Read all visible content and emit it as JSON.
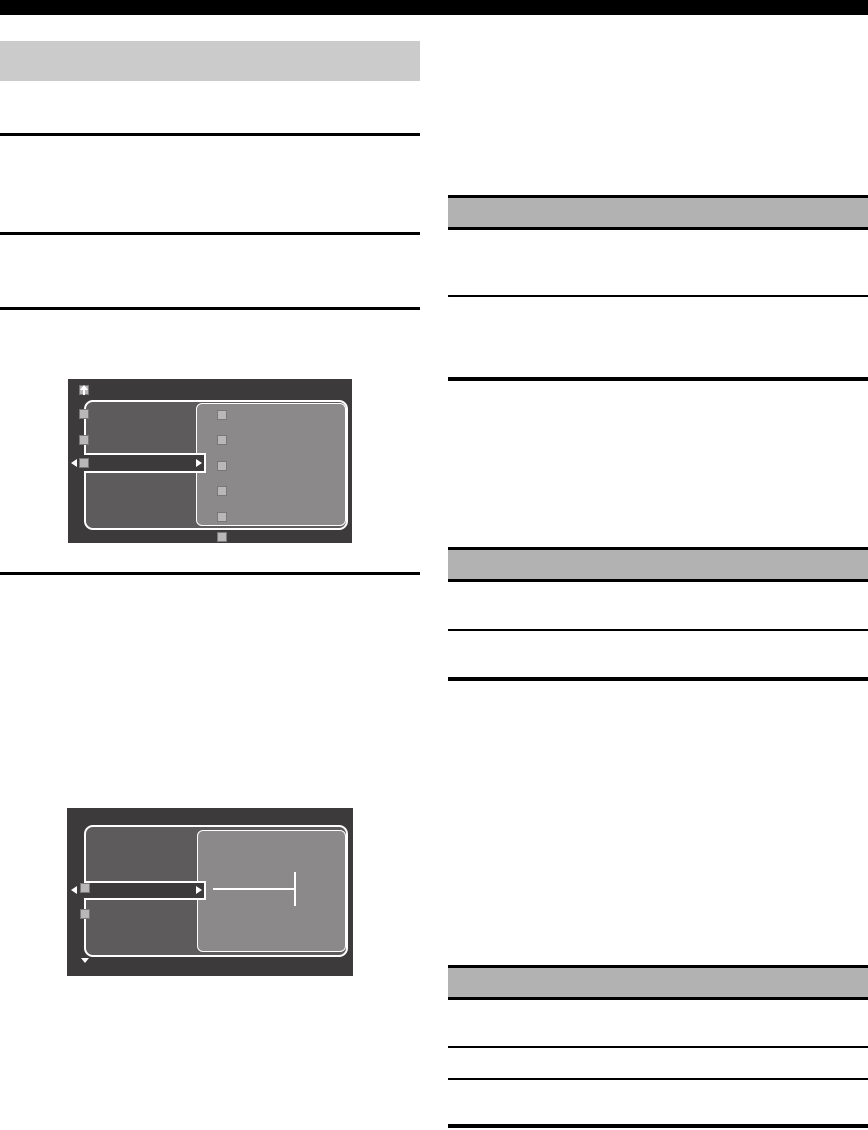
{
  "meta": {
    "description": "blank manual page layout with two on-screen-display menu illustrations; no readable text is rendered on the page",
    "text_visible": false
  },
  "colors": {
    "page_bg": "#ffffff",
    "top_bar": "#000000",
    "rule": "#000000",
    "left_header_bg": "#cbcbcb",
    "right_header_bg": "#b2b2b2",
    "screen_bg": "#3c3a3a",
    "screen_left_panel": "#5d5b5b",
    "screen_right_panel": "#8b8989",
    "placeholder_square": "#b9b7b7",
    "screen_border": "#ffffff"
  },
  "left_column": {
    "header_bar": {
      "text": ""
    },
    "horizontal_rules": 4
  },
  "right_column": {
    "sections": [
      {
        "header_text": "",
        "rules_below": 2
      },
      {
        "header_text": "",
        "rules_below": 2
      },
      {
        "header_text": "",
        "rules_below": 3
      }
    ]
  },
  "figures": [
    {
      "name": "osd-menu-list-screen",
      "icons": [
        "up-arrow-icon",
        "left-arrow-icon",
        "right-arrow-icon"
      ],
      "left_placeholder_squares": 3,
      "right_placeholder_squares": 5,
      "bottom_placeholder_squares": 1,
      "selected_row_highlighted": true
    },
    {
      "name": "osd-menu-adjust-screen",
      "icons": [
        "left-arrow-icon",
        "right-arrow-icon",
        "down-arrow-icon"
      ],
      "left_placeholder_squares": 2,
      "slider": {
        "present": true,
        "cursor_position": "right-end"
      },
      "selected_row_highlighted": true
    }
  ]
}
